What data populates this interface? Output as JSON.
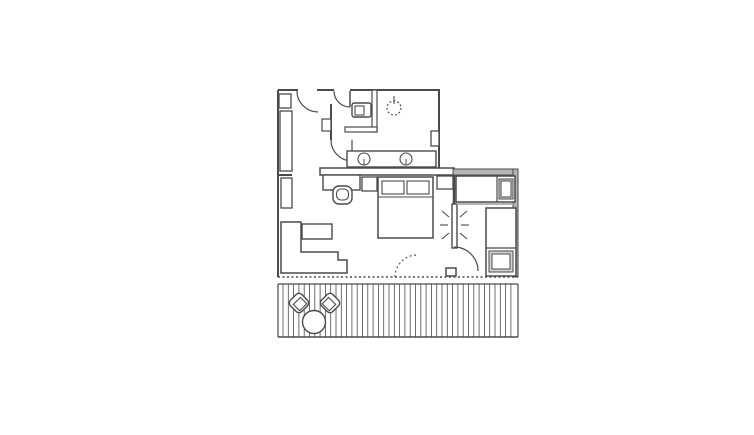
{
  "title": "hotel-suite-floor-plan",
  "canvas": {
    "width": 754,
    "height": 435
  },
  "colors": {
    "background": "#ffffff",
    "line": "#4a4a4a",
    "wall_shade": "#b4b4b4",
    "pillow_shade": "#d2d2d2",
    "white": "#ffffff"
  },
  "rooms": [
    "entry-hall",
    "bathroom",
    "wc",
    "shower",
    "bedroom-living-area",
    "second-bedroom",
    "balcony"
  ],
  "plan": {
    "elements": [
      {
        "name": "wall-top-left",
        "type": "line",
        "x1": 278,
        "y1": 90,
        "x2": 298,
        "y2": 90,
        "sw": 2
      },
      {
        "name": "wall-top-mid",
        "type": "line",
        "x1": 317,
        "y1": 90,
        "x2": 334,
        "y2": 90,
        "sw": 2
      },
      {
        "name": "wall-top-right",
        "type": "line",
        "x1": 350,
        "y1": 90,
        "x2": 440,
        "y2": 90,
        "sw": 2
      },
      {
        "name": "wall-left",
        "type": "line",
        "x1": 278,
        "y1": 90,
        "x2": 278,
        "y2": 277,
        "sw": 2
      },
      {
        "name": "wall-bathroom-right",
        "type": "line",
        "x1": 439,
        "y1": 90,
        "x2": 439,
        "y2": 170,
        "sw": 2
      },
      {
        "name": "wall-headboard",
        "type": "rect",
        "x": 320,
        "y": 168,
        "w": 134,
        "h": 7,
        "fill": "#ffffff",
        "sw": 1.5
      },
      {
        "name": "wall-second-room-top",
        "type": "rect",
        "x": 453,
        "y": 169,
        "w": 65,
        "h": 6,
        "fill": "#b4b4b4",
        "sw": 1
      },
      {
        "name": "wall-right",
        "type": "rect",
        "x": 513,
        "y": 169,
        "w": 5,
        "h": 108,
        "fill": "#b4b4b4",
        "sw": 1
      },
      {
        "name": "wall-divider",
        "type": "line",
        "x1": 454,
        "y1": 175,
        "x2": 454,
        "y2": 205,
        "sw": 2.5
      },
      {
        "name": "window-line",
        "type": "line",
        "x1": 278,
        "y1": 277,
        "x2": 518,
        "y2": 277,
        "sw": 1.5,
        "dash": "2,2.5"
      },
      {
        "name": "wall-hall-bottom",
        "type": "line",
        "x1": 278,
        "y1": 175,
        "x2": 292,
        "y2": 175,
        "sw": 2
      },
      {
        "name": "entry-door-arc",
        "type": "path",
        "d": "M297,91 A21,21 0 0 0 318,112",
        "sw": 1.2
      },
      {
        "name": "bathroom-door-leaf",
        "type": "line",
        "x1": 350,
        "y1": 91,
        "x2": 350,
        "y2": 107,
        "sw": 1.5
      },
      {
        "name": "bathroom-door-arc",
        "type": "path",
        "d": "M334,91 A16,16 0 0 0 350,107",
        "sw": 1.2
      },
      {
        "name": "hall-partition",
        "type": "line",
        "x1": 331,
        "y1": 104,
        "x2": 331,
        "y2": 140,
        "sw": 2
      },
      {
        "name": "switch-box",
        "type": "rect",
        "x": 322,
        "y": 119,
        "w": 9,
        "h": 12,
        "fill": "#ffffff",
        "sw": 1.2
      },
      {
        "name": "vanity-door-leaf",
        "type": "line",
        "x1": 352,
        "y1": 140,
        "x2": 352,
        "y2": 161,
        "sw": 1.2
      },
      {
        "name": "vanity-door-arc",
        "type": "path",
        "d": "M331,140 A21,21 0 0 0 352,161",
        "sw": 1.2
      },
      {
        "name": "wall-wc-vertical",
        "type": "rect",
        "x": 372,
        "y": 90,
        "w": 5,
        "h": 42,
        "fill": "#ffffff",
        "sw": 1.2
      },
      {
        "name": "wall-wc-horizontal",
        "type": "rect",
        "x": 345,
        "y": 127,
        "w": 32,
        "h": 5,
        "fill": "#ffffff",
        "sw": 1.2
      },
      {
        "name": "toilet",
        "type": "rect",
        "x": 352,
        "y": 103,
        "w": 19,
        "h": 14,
        "rx": 2,
        "fill": "#ffffff",
        "sw": 1.4
      },
      {
        "name": "toilet-cistern",
        "type": "rect",
        "x": 355,
        "y": 106,
        "w": 9,
        "h": 9,
        "fill": "#ffffff",
        "sw": 1.1
      },
      {
        "name": "shower-head",
        "type": "circle",
        "cx": 394,
        "cy": 108,
        "r": 7,
        "fill": "none",
        "sw": 1.1,
        "dash": "2,2"
      },
      {
        "name": "shower-head-tick",
        "type": "line",
        "x1": 394,
        "y1": 96,
        "x2": 394,
        "y2": 104,
        "sw": 1.1
      },
      {
        "name": "wall-niche",
        "type": "rect",
        "x": 431,
        "y": 131,
        "w": 8,
        "h": 15,
        "fill": "#ffffff",
        "sw": 1.3
      },
      {
        "name": "vanity-counter",
        "type": "rect",
        "x": 347,
        "y": 151,
        "w": 89,
        "h": 16,
        "fill": "#ffffff",
        "sw": 1.4
      },
      {
        "name": "sink-left",
        "type": "circle",
        "cx": 364,
        "cy": 159,
        "r": 6,
        "fill": "#ffffff",
        "sw": 1.1
      },
      {
        "name": "sink-left-tap",
        "type": "line",
        "x1": 364,
        "y1": 159,
        "x2": 364,
        "y2": 165,
        "sw": 1
      },
      {
        "name": "sink-right",
        "type": "circle",
        "cx": 406,
        "cy": 159,
        "r": 6,
        "fill": "#ffffff",
        "sw": 1.1
      },
      {
        "name": "sink-right-tap",
        "type": "line",
        "x1": 406,
        "y1": 159,
        "x2": 406,
        "y2": 165,
        "sw": 1
      },
      {
        "name": "wall-pier",
        "type": "rect",
        "x": 279,
        "y": 94,
        "w": 12,
        "h": 14,
        "fill": "#ffffff",
        "sw": 1.3
      },
      {
        "name": "wardrobe",
        "type": "rect",
        "x": 280,
        "y": 111,
        "w": 12,
        "h": 60,
        "fill": "#ffffff",
        "sw": 1.3
      },
      {
        "name": "closet",
        "type": "rect",
        "x": 281,
        "y": 178,
        "w": 11,
        "h": 30,
        "fill": "#ffffff",
        "sw": 1.3
      },
      {
        "name": "desk",
        "type": "rect",
        "x": 323,
        "y": 175,
        "w": 37,
        "h": 15,
        "fill": "#ffffff",
        "sw": 1.4
      },
      {
        "name": "desk-chair-back",
        "type": "rect",
        "x": 333,
        "y": 186,
        "w": 19,
        "h": 18,
        "rx": 6,
        "fill": "#ffffff",
        "sw": 1.4
      },
      {
        "name": "desk-chair-seat",
        "type": "rect",
        "x": 336.5,
        "y": 189,
        "w": 12,
        "h": 11,
        "rx": 4.5,
        "fill": "#ffffff",
        "sw": 1.1
      },
      {
        "name": "nightstand-left",
        "type": "rect",
        "x": 362,
        "y": 177,
        "w": 15,
        "h": 14,
        "fill": "#ffffff",
        "sw": 1.3
      },
      {
        "name": "nightstand-right",
        "type": "rect",
        "x": 437,
        "y": 176,
        "w": 16,
        "h": 13,
        "fill": "#ffffff",
        "sw": 1.3
      },
      {
        "name": "double-bed",
        "type": "rect",
        "x": 378,
        "y": 177,
        "w": 55,
        "h": 61,
        "fill": "#ffffff",
        "sw": 1.5
      },
      {
        "name": "double-bed-sheet-line",
        "type": "line",
        "x1": 378,
        "y1": 197,
        "x2": 433,
        "y2": 197,
        "sw": 1.1
      },
      {
        "name": "pillow-left",
        "type": "rect",
        "x": 382,
        "y": 181,
        "w": 22,
        "h": 13,
        "fill": "#ffffff",
        "sw": 1.1
      },
      {
        "name": "pillow-right",
        "type": "rect",
        "x": 407,
        "y": 181,
        "w": 22,
        "h": 13,
        "fill": "#ffffff",
        "sw": 1.1
      },
      {
        "name": "coffee-table",
        "type": "rect",
        "x": 302,
        "y": 224,
        "w": 30,
        "h": 15,
        "fill": "#ffffff",
        "sw": 1.4
      },
      {
        "name": "sofa",
        "type": "path",
        "d": "M281,222 L301,222 L301,252 L338,252 L338,260 L347,260 L347,273 L281,273 Z",
        "fill": "#ffffff",
        "sw": 1.5
      },
      {
        "name": "balcony-door-arc",
        "type": "path",
        "d": "M395,277 A22,22 0 0 1 417,255",
        "sw": 1.1,
        "dash": "2,2.5"
      },
      {
        "name": "mirror",
        "type": "rect",
        "x": 452,
        "y": 204,
        "w": 5,
        "h": 44,
        "fill": "#ffffff",
        "sw": 1.4
      },
      {
        "name": "mirror-ray-left-1",
        "type": "line",
        "x1": 449,
        "y1": 217,
        "x2": 442,
        "y2": 211,
        "sw": 1.1
      },
      {
        "name": "mirror-ray-left-2",
        "type": "line",
        "x1": 448,
        "y1": 225,
        "x2": 440,
        "y2": 225,
        "sw": 1.1
      },
      {
        "name": "mirror-ray-left-3",
        "type": "line",
        "x1": 449,
        "y1": 233,
        "x2": 442,
        "y2": 239,
        "sw": 1.1
      },
      {
        "name": "mirror-ray-right-1",
        "type": "line",
        "x1": 460,
        "y1": 217,
        "x2": 467,
        "y2": 211,
        "sw": 1.1
      },
      {
        "name": "mirror-ray-right-2",
        "type": "line",
        "x1": 461,
        "y1": 225,
        "x2": 469,
        "y2": 225,
        "sw": 1.1
      },
      {
        "name": "mirror-ray-right-3",
        "type": "line",
        "x1": 460,
        "y1": 233,
        "x2": 467,
        "y2": 239,
        "sw": 1.1
      },
      {
        "name": "single-bed-top",
        "type": "rect",
        "x": 456,
        "y": 176,
        "w": 59,
        "h": 26,
        "fill": "#ffffff",
        "sw": 1.5
      },
      {
        "name": "single-bed-top-divider",
        "type": "line",
        "x1": 497,
        "y1": 176,
        "x2": 497,
        "y2": 202,
        "sw": 1.2
      },
      {
        "name": "single-bed-top-shadow",
        "type": "line",
        "x1": 457,
        "y1": 204,
        "x2": 513,
        "y2": 204,
        "sw": 2,
        "stroke": "#b4b4b4"
      },
      {
        "name": "single-bed-top-pillow-outer",
        "type": "rect",
        "x": 499,
        "y": 179,
        "w": 14,
        "h": 20,
        "fill": "#d2d2d2",
        "sw": 1
      },
      {
        "name": "single-bed-top-pillow",
        "type": "rect",
        "x": 501,
        "y": 181,
        "w": 10,
        "h": 16,
        "fill": "#ffffff",
        "sw": 1
      },
      {
        "name": "single-bed-side",
        "type": "rect",
        "x": 486,
        "y": 208,
        "w": 30,
        "h": 68,
        "fill": "#ffffff",
        "sw": 1.5
      },
      {
        "name": "single-bed-side-divider",
        "type": "line",
        "x1": 486,
        "y1": 248,
        "x2": 516,
        "y2": 248,
        "sw": 1.2
      },
      {
        "name": "single-bed-side-pillow-outer",
        "type": "rect",
        "x": 489,
        "y": 251,
        "w": 24,
        "h": 21,
        "fill": "#d2d2d2",
        "sw": 1
      },
      {
        "name": "single-bed-side-pillow",
        "type": "rect",
        "x": 492,
        "y": 254,
        "w": 18,
        "h": 15,
        "fill": "#ffffff",
        "sw": 1
      },
      {
        "name": "second-room-door-arc",
        "type": "path",
        "d": "M454,247 A24,24 0 0 1 478,271",
        "sw": 1.2
      },
      {
        "name": "wall-stub-door",
        "type": "rect",
        "x": 446,
        "y": 268,
        "w": 10,
        "h": 8,
        "fill": "#ffffff",
        "sw": 1.5
      },
      {
        "name": "balcony-top-edge",
        "type": "line",
        "x1": 278,
        "y1": 284,
        "x2": 518,
        "y2": 284,
        "sw": 1.2
      },
      {
        "name": "balcony-bottom-edge",
        "type": "line",
        "x1": 278,
        "y1": 337,
        "x2": 518,
        "y2": 337,
        "sw": 1.5
      },
      {
        "name": "balcony-left-edge",
        "type": "line",
        "x1": 278,
        "y1": 284,
        "x2": 278,
        "y2": 337,
        "sw": 1.2
      },
      {
        "name": "balcony-right-edge",
        "type": "line",
        "x1": 518,
        "y1": 284,
        "x2": 518,
        "y2": 337,
        "sw": 1.2
      },
      {
        "name": "deck-planks",
        "type": "planks",
        "x1": 283,
        "x2": 515,
        "y1": 284,
        "y2": 337,
        "gap": 5.3,
        "sw": 0.8
      },
      {
        "name": "patio-chair-left-back",
        "type": "rect",
        "x": 291,
        "y": 295,
        "w": 16,
        "h": 16,
        "rx": 4,
        "fill": "#ffffff",
        "sw": 1.4,
        "rotate": [
          -45,
          299,
          303
        ]
      },
      {
        "name": "patio-chair-left-seat",
        "type": "rect",
        "x": 294,
        "y": 300,
        "w": 10,
        "h": 9,
        "fill": "#ffffff",
        "sw": 1.1,
        "rotate": [
          -45,
          299,
          303
        ]
      },
      {
        "name": "patio-chair-right-back",
        "type": "rect",
        "x": 322,
        "y": 295,
        "w": 16,
        "h": 16,
        "rx": 4,
        "fill": "#ffffff",
        "sw": 1.4,
        "rotate": [
          45,
          330,
          303
        ]
      },
      {
        "name": "patio-chair-right-seat",
        "type": "rect",
        "x": 325,
        "y": 300,
        "w": 10,
        "h": 9,
        "fill": "#ffffff",
        "sw": 1.1,
        "rotate": [
          45,
          330,
          303
        ]
      },
      {
        "name": "patio-table",
        "type": "circle",
        "cx": 314,
        "cy": 322,
        "r": 11.5,
        "fill": "#ffffff",
        "sw": 1.4
      }
    ]
  }
}
